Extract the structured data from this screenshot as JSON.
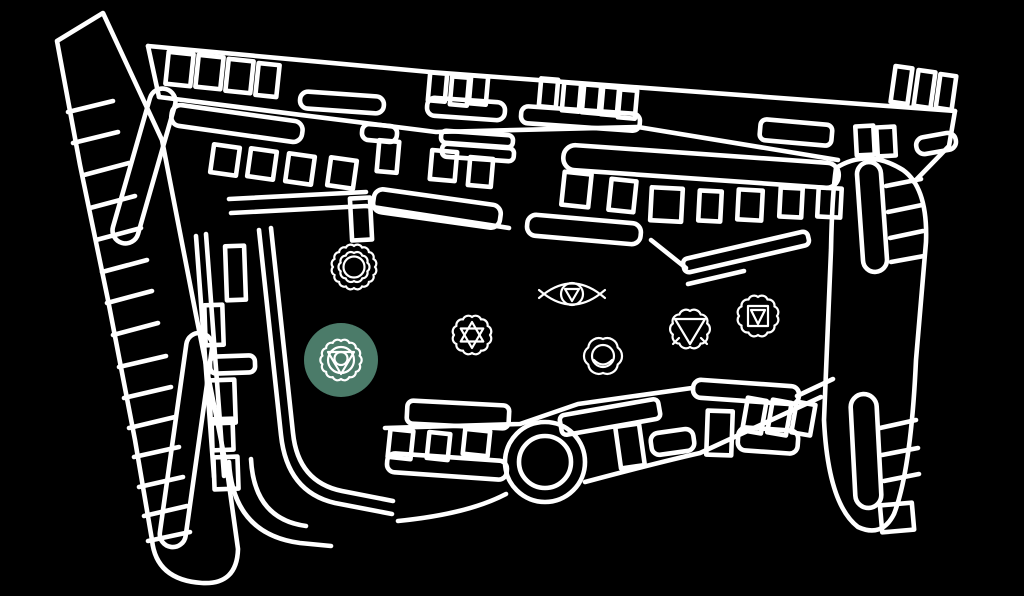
{
  "page": {
    "background": "#000000",
    "description": "Illustrated site map (white line art) with seven chakra location markers; throat chakra marker highlighted"
  },
  "map": {
    "line_color": "#ffffff",
    "highlight_color": "#4B7B69",
    "markers": [
      {
        "id": "sahasrara",
        "name": "Crown chakra marker",
        "x": 354,
        "y": 267,
        "highlighted": false
      },
      {
        "id": "vishuddha",
        "name": "Throat chakra marker",
        "x": 341,
        "y": 360,
        "highlighted": true
      },
      {
        "id": "anahata",
        "name": "Heart chakra marker",
        "x": 472,
        "y": 335,
        "highlighted": false
      },
      {
        "id": "ajna",
        "name": "Third-eye chakra marker",
        "x": 572,
        "y": 294,
        "highlighted": false
      },
      {
        "id": "svadhisthana",
        "name": "Sacral chakra marker",
        "x": 603,
        "y": 356,
        "highlighted": false
      },
      {
        "id": "manipura",
        "name": "Solar-plexus chakra marker",
        "x": 690,
        "y": 329,
        "highlighted": false
      },
      {
        "id": "muladhara",
        "name": "Root chakra marker",
        "x": 758,
        "y": 316,
        "highlighted": false
      }
    ]
  }
}
